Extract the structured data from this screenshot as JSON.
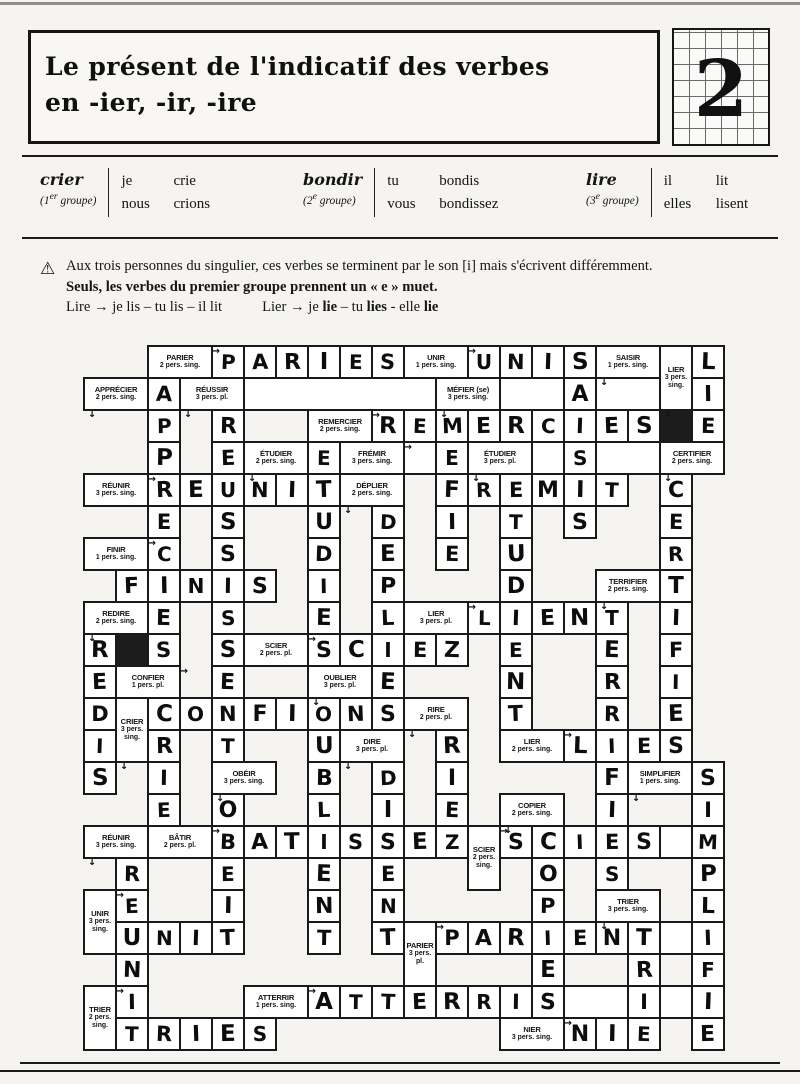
{
  "header": {
    "title_line1": "Le présent de l'indicatif des verbes",
    "title_line2": "en -ier, -ir, -ire",
    "number": "2"
  },
  "examples": [
    {
      "verb": "crier",
      "grp_open": "(1",
      "grp_sup": "er",
      "grp_close": " groupe)",
      "rows": [
        [
          "je",
          "crie"
        ],
        [
          "nous",
          "crions"
        ]
      ]
    },
    {
      "verb": "bondir",
      "grp_open": "(2",
      "grp_sup": "e",
      "grp_close": " groupe)",
      "rows": [
        [
          "tu",
          "bondis"
        ],
        [
          "vous",
          "bondissez"
        ]
      ]
    },
    {
      "verb": "lire",
      "grp_open": "(3",
      "grp_sup": "e",
      "grp_close": " groupe)",
      "rows": [
        [
          "il",
          "lit"
        ],
        [
          "elles",
          "lisent"
        ]
      ]
    }
  ],
  "note": {
    "icon": "⚠",
    "line1": "Aux trois personnes du singulier, ces verbes se terminent par le son [i] mais s'écrivent différemment.",
    "line2": "Seuls, les verbes du premier groupe prennent un « e » muet.",
    "line3_lire": "Lire → je lis – tu lis – il lit",
    "line3_lier_parts": [
      "Lier → je ",
      "lie",
      " – tu ",
      "lies",
      " - elle ",
      "lie"
    ]
  },
  "puzzle": {
    "grid": {
      "left": 84,
      "top": 346,
      "cell": 32,
      "cols": 20,
      "rows": 22
    },
    "arrow_chars": {
      "h": "→",
      "v": "↓"
    },
    "clues": [
      {
        "word": "PARIER",
        "person": "2 pers. sing.",
        "c": 2,
        "r": 0,
        "cs": 2,
        "rs": 1,
        "dir": "h"
      },
      {
        "word": "UNIR",
        "person": "1 pers. sing.",
        "c": 10,
        "r": 0,
        "cs": 2,
        "rs": 1,
        "dir": "h"
      },
      {
        "word": "SAISIR",
        "person": "1 pers. sing.",
        "c": 16,
        "r": 0,
        "cs": 2,
        "rs": 1,
        "dir": "v"
      },
      {
        "word": "LIER",
        "person": "3 pers. sing.",
        "c": 18,
        "r": 0,
        "cs": 1,
        "rs": 2,
        "dir": "v"
      },
      {
        "word": "APPRÉCIER",
        "person": "2 pers. sing.",
        "c": 0,
        "r": 1,
        "cs": 2,
        "rs": 1,
        "dir": "v"
      },
      {
        "word": "RÉUSSIR",
        "person": "3 pers. pl.",
        "c": 3,
        "r": 1,
        "cs": 2,
        "rs": 1,
        "dir": "v"
      },
      {
        "word": "MÉFIER (se)",
        "person": "3 pers. sing.",
        "c": 11,
        "r": 1,
        "cs": 2,
        "rs": 1,
        "dir": "v"
      },
      {
        "word": "REMERCIER",
        "person": "2 pers. sing.",
        "c": 7,
        "r": 2,
        "cs": 2,
        "rs": 1,
        "dir": "h"
      },
      {
        "word": "ÉTUDIER",
        "person": "2 pers. sing.",
        "c": 5,
        "r": 3,
        "cs": 2,
        "rs": 1,
        "dir": "v"
      },
      {
        "word": "FRÉMIR",
        "person": "3 pers. sing.",
        "c": 8,
        "r": 3,
        "cs": 2,
        "rs": 1,
        "dir": "h"
      },
      {
        "word": "ÉTUDIER",
        "person": "3 pers. pl.",
        "c": 12,
        "r": 3,
        "cs": 2,
        "rs": 1,
        "dir": "v"
      },
      {
        "word": "CERTIFIER",
        "person": "2 pers. sing.",
        "c": 18,
        "r": 3,
        "cs": 2,
        "rs": 1,
        "dir": "v"
      },
      {
        "word": "RÉUNIR",
        "person": "3 pers. sing.",
        "c": 0,
        "r": 4,
        "cs": 2,
        "rs": 1,
        "dir": "h"
      },
      {
        "word": "DÉPLIER",
        "person": "2 pers. sing.",
        "c": 8,
        "r": 4,
        "cs": 2,
        "rs": 1,
        "dir": "v"
      },
      {
        "word": "FINIR",
        "person": "1 pers. sing.",
        "c": 0,
        "r": 6,
        "cs": 2,
        "rs": 1,
        "dir": "h"
      },
      {
        "word": "TERRIFIER",
        "person": "2 pers. sing.",
        "c": 16,
        "r": 7,
        "cs": 2,
        "rs": 1,
        "dir": "v"
      },
      {
        "word": "REDIRE",
        "person": "2 pers. sing.",
        "c": 0,
        "r": 8,
        "cs": 2,
        "rs": 1,
        "dir": "v"
      },
      {
        "word": "LIER",
        "person": "3 pers. pl.",
        "c": 10,
        "r": 8,
        "cs": 2,
        "rs": 1,
        "dir": "h"
      },
      {
        "word": "SCIER",
        "person": "2 pers. pl.",
        "c": 5,
        "r": 9,
        "cs": 2,
        "rs": 1,
        "dir": "h"
      },
      {
        "word": "CONFIER",
        "person": "1 pers. pl.",
        "c": 1,
        "r": 10,
        "cs": 2,
        "rs": 1,
        "dir": "h"
      },
      {
        "word": "OUBLIER",
        "person": "3 pers. pl.",
        "c": 7,
        "r": 10,
        "cs": 2,
        "rs": 1,
        "dir": "v"
      },
      {
        "word": "CRIER",
        "person": "3 pers. sing.",
        "c": 1,
        "r": 11,
        "cs": 1,
        "rs": 2,
        "dir": "v"
      },
      {
        "word": "RIRE",
        "person": "2 pers. pl.",
        "c": 10,
        "r": 11,
        "cs": 2,
        "rs": 1,
        "dir": "v"
      },
      {
        "word": "DIRE",
        "person": "3 pers. pl.",
        "c": 8,
        "r": 12,
        "cs": 2,
        "rs": 1,
        "dir": "v"
      },
      {
        "word": "LIER",
        "person": "2 pers. sing.",
        "c": 13,
        "r": 12,
        "cs": 2,
        "rs": 1,
        "dir": "h"
      },
      {
        "word": "OBÉIR",
        "person": "3 pers. sing.",
        "c": 4,
        "r": 13,
        "cs": 2,
        "rs": 1,
        "dir": "v"
      },
      {
        "word": "SIMPLIFIER",
        "person": "1 pers. sing.",
        "c": 17,
        "r": 13,
        "cs": 2,
        "rs": 1,
        "dir": "v"
      },
      {
        "word": "COPIER",
        "person": "2 pers. sing.",
        "c": 13,
        "r": 14,
        "cs": 2,
        "rs": 1,
        "dir": "v"
      },
      {
        "word": "RÉUNIR",
        "person": "3 pers. sing.",
        "c": 0,
        "r": 15,
        "cs": 2,
        "rs": 1,
        "dir": "v"
      },
      {
        "word": "BÂTIR",
        "person": "2 pers. pl.",
        "c": 2,
        "r": 15,
        "cs": 2,
        "rs": 1,
        "dir": "h"
      },
      {
        "word": "SCIER",
        "person": "2 pers. sing.",
        "c": 12,
        "r": 15,
        "cs": 1,
        "rs": 2,
        "dir": "h"
      },
      {
        "word": "UNIR",
        "person": "3 pers. sing.",
        "c": 0,
        "r": 17,
        "cs": 1,
        "rs": 2,
        "dir": "h"
      },
      {
        "word": "TRIER",
        "person": "3 pers. sing.",
        "c": 16,
        "r": 17,
        "cs": 2,
        "rs": 1,
        "dir": "v"
      },
      {
        "word": "PARIER",
        "person": "3 pers. pl.",
        "c": 10,
        "r": 18,
        "cs": 1,
        "rs": 2,
        "dir": "h"
      },
      {
        "word": "ATTERRIR",
        "person": "1 pers. sing.",
        "c": 5,
        "r": 20,
        "cs": 2,
        "rs": 1,
        "dir": "h"
      },
      {
        "word": "TRIER",
        "person": "2 pers. sing.",
        "c": 0,
        "r": 20,
        "cs": 1,
        "rs": 2,
        "dir": "h"
      },
      {
        "word": "NIER",
        "person": "3 pers. sing.",
        "c": 13,
        "r": 21,
        "cs": 2,
        "rs": 1,
        "dir": "h"
      }
    ],
    "black": [
      [
        2,
        18
      ],
      [
        9,
        1
      ]
    ],
    "empty": [
      {
        "r": 1,
        "c": 5,
        "cs": 6
      },
      {
        "r": 1,
        "c": 13,
        "cs": 2
      },
      {
        "r": 1,
        "c": 16,
        "cs": 2
      },
      {
        "r": 3,
        "c": 10,
        "cs": 1
      },
      {
        "r": 3,
        "c": 14,
        "cs": 1
      },
      {
        "r": 3,
        "c": 16,
        "cs": 2
      },
      {
        "r": 15,
        "c": 18,
        "cs": 1
      },
      {
        "r": 18,
        "c": 18,
        "cs": 1
      },
      {
        "r": 20,
        "c": 15,
        "cs": 2
      },
      {
        "r": 20,
        "c": 18,
        "cs": 1
      }
    ],
    "letters": [
      [
        0,
        4,
        "P"
      ],
      [
        0,
        5,
        "A"
      ],
      [
        0,
        6,
        "R"
      ],
      [
        0,
        7,
        "I"
      ],
      [
        0,
        8,
        "E"
      ],
      [
        0,
        9,
        "S"
      ],
      [
        0,
        12,
        "U"
      ],
      [
        0,
        13,
        "N"
      ],
      [
        0,
        14,
        "I"
      ],
      [
        0,
        15,
        "S"
      ],
      [
        0,
        19,
        "L"
      ],
      [
        1,
        2,
        "A"
      ],
      [
        1,
        15,
        "A"
      ],
      [
        1,
        19,
        "I"
      ],
      [
        2,
        2,
        "P"
      ],
      [
        2,
        4,
        "R"
      ],
      [
        2,
        9,
        "R"
      ],
      [
        2,
        10,
        "E"
      ],
      [
        2,
        11,
        "M"
      ],
      [
        2,
        12,
        "E"
      ],
      [
        2,
        13,
        "R"
      ],
      [
        2,
        14,
        "C"
      ],
      [
        2,
        15,
        "I"
      ],
      [
        2,
        16,
        "E"
      ],
      [
        2,
        17,
        "S"
      ],
      [
        2,
        19,
        "E"
      ],
      [
        3,
        2,
        "P"
      ],
      [
        3,
        4,
        "E"
      ],
      [
        3,
        7,
        "E"
      ],
      [
        3,
        11,
        "E"
      ],
      [
        3,
        15,
        "S"
      ],
      [
        4,
        2,
        "R"
      ],
      [
        4,
        3,
        "E"
      ],
      [
        4,
        4,
        "U"
      ],
      [
        4,
        5,
        "N"
      ],
      [
        4,
        6,
        "I"
      ],
      [
        4,
        7,
        "T"
      ],
      [
        4,
        11,
        "F"
      ],
      [
        4,
        12,
        "R"
      ],
      [
        4,
        13,
        "E"
      ],
      [
        4,
        14,
        "M"
      ],
      [
        4,
        15,
        "I"
      ],
      [
        4,
        16,
        "T"
      ],
      [
        4,
        18,
        "C"
      ],
      [
        5,
        2,
        "E"
      ],
      [
        5,
        4,
        "S"
      ],
      [
        5,
        7,
        "U"
      ],
      [
        5,
        9,
        "D"
      ],
      [
        5,
        11,
        "I"
      ],
      [
        5,
        13,
        "T"
      ],
      [
        5,
        15,
        "S"
      ],
      [
        5,
        18,
        "E"
      ],
      [
        6,
        2,
        "C"
      ],
      [
        6,
        4,
        "S"
      ],
      [
        6,
        7,
        "D"
      ],
      [
        6,
        9,
        "E"
      ],
      [
        6,
        11,
        "E"
      ],
      [
        6,
        13,
        "U"
      ],
      [
        6,
        18,
        "R"
      ],
      [
        7,
        1,
        "F"
      ],
      [
        7,
        2,
        "I"
      ],
      [
        7,
        3,
        "N"
      ],
      [
        7,
        4,
        "I"
      ],
      [
        7,
        5,
        "S"
      ],
      [
        7,
        7,
        "I"
      ],
      [
        7,
        9,
        "P"
      ],
      [
        7,
        13,
        "D"
      ],
      [
        7,
        18,
        "T"
      ],
      [
        8,
        2,
        "E"
      ],
      [
        8,
        4,
        "S"
      ],
      [
        8,
        7,
        "E"
      ],
      [
        8,
        9,
        "L"
      ],
      [
        8,
        12,
        "L"
      ],
      [
        8,
        13,
        "I"
      ],
      [
        8,
        14,
        "E"
      ],
      [
        8,
        15,
        "N"
      ],
      [
        8,
        16,
        "T"
      ],
      [
        8,
        18,
        "I"
      ],
      [
        9,
        0,
        "R"
      ],
      [
        9,
        2,
        "S"
      ],
      [
        9,
        4,
        "S"
      ],
      [
        9,
        7,
        "S"
      ],
      [
        9,
        8,
        "C"
      ],
      [
        9,
        9,
        "I"
      ],
      [
        9,
        10,
        "E"
      ],
      [
        9,
        11,
        "Z"
      ],
      [
        9,
        13,
        "E"
      ],
      [
        9,
        16,
        "E"
      ],
      [
        9,
        18,
        "F"
      ],
      [
        10,
        0,
        "E"
      ],
      [
        10,
        4,
        "E"
      ],
      [
        10,
        9,
        "E"
      ],
      [
        10,
        13,
        "N"
      ],
      [
        10,
        16,
        "R"
      ],
      [
        10,
        18,
        "I"
      ],
      [
        11,
        0,
        "D"
      ],
      [
        11,
        2,
        "C"
      ],
      [
        11,
        3,
        "O"
      ],
      [
        11,
        4,
        "N"
      ],
      [
        11,
        5,
        "F"
      ],
      [
        11,
        6,
        "I"
      ],
      [
        11,
        7,
        "O"
      ],
      [
        11,
        8,
        "N"
      ],
      [
        11,
        9,
        "S"
      ],
      [
        11,
        13,
        "T"
      ],
      [
        11,
        16,
        "R"
      ],
      [
        11,
        18,
        "E"
      ],
      [
        12,
        0,
        "I"
      ],
      [
        12,
        2,
        "R"
      ],
      [
        12,
        4,
        "T"
      ],
      [
        12,
        7,
        "U"
      ],
      [
        12,
        11,
        "R"
      ],
      [
        12,
        15,
        "L"
      ],
      [
        12,
        16,
        "I"
      ],
      [
        12,
        17,
        "E"
      ],
      [
        12,
        18,
        "S"
      ],
      [
        13,
        0,
        "S"
      ],
      [
        13,
        2,
        "I"
      ],
      [
        13,
        7,
        "B"
      ],
      [
        13,
        9,
        "D"
      ],
      [
        13,
        11,
        "I"
      ],
      [
        13,
        16,
        "F"
      ],
      [
        13,
        19,
        "S"
      ],
      [
        14,
        2,
        "E"
      ],
      [
        14,
        4,
        "O"
      ],
      [
        14,
        7,
        "L"
      ],
      [
        14,
        9,
        "I"
      ],
      [
        14,
        11,
        "E"
      ],
      [
        14,
        16,
        "I"
      ],
      [
        14,
        19,
        "I"
      ],
      [
        15,
        4,
        "B"
      ],
      [
        15,
        5,
        "A"
      ],
      [
        15,
        6,
        "T"
      ],
      [
        15,
        7,
        "I"
      ],
      [
        15,
        8,
        "S"
      ],
      [
        15,
        9,
        "S"
      ],
      [
        15,
        10,
        "E"
      ],
      [
        15,
        11,
        "Z"
      ],
      [
        15,
        13,
        "S"
      ],
      [
        15,
        14,
        "C"
      ],
      [
        15,
        15,
        "I"
      ],
      [
        15,
        16,
        "E"
      ],
      [
        15,
        17,
        "S"
      ],
      [
        15,
        19,
        "M"
      ],
      [
        16,
        1,
        "R"
      ],
      [
        16,
        4,
        "E"
      ],
      [
        16,
        7,
        "E"
      ],
      [
        16,
        9,
        "E"
      ],
      [
        16,
        14,
        "O"
      ],
      [
        16,
        16,
        "S"
      ],
      [
        16,
        19,
        "P"
      ],
      [
        17,
        1,
        "E"
      ],
      [
        17,
        4,
        "I"
      ],
      [
        17,
        7,
        "N"
      ],
      [
        17,
        9,
        "N"
      ],
      [
        17,
        14,
        "P"
      ],
      [
        17,
        19,
        "L"
      ],
      [
        18,
        1,
        "U"
      ],
      [
        18,
        2,
        "N"
      ],
      [
        18,
        3,
        "I"
      ],
      [
        18,
        4,
        "T"
      ],
      [
        18,
        7,
        "T"
      ],
      [
        18,
        9,
        "T"
      ],
      [
        18,
        11,
        "P"
      ],
      [
        18,
        12,
        "A"
      ],
      [
        18,
        13,
        "R"
      ],
      [
        18,
        14,
        "I"
      ],
      [
        18,
        15,
        "E"
      ],
      [
        18,
        16,
        "N"
      ],
      [
        18,
        17,
        "T"
      ],
      [
        18,
        19,
        "I"
      ],
      [
        19,
        1,
        "N"
      ],
      [
        19,
        14,
        "E"
      ],
      [
        19,
        17,
        "R"
      ],
      [
        19,
        19,
        "F"
      ],
      [
        20,
        1,
        "I"
      ],
      [
        20,
        7,
        "A"
      ],
      [
        20,
        8,
        "T"
      ],
      [
        20,
        9,
        "T"
      ],
      [
        20,
        10,
        "E"
      ],
      [
        20,
        11,
        "R"
      ],
      [
        20,
        12,
        "R"
      ],
      [
        20,
        13,
        "I"
      ],
      [
        20,
        14,
        "S"
      ],
      [
        20,
        17,
        "I"
      ],
      [
        20,
        19,
        "I"
      ],
      [
        21,
        1,
        "T"
      ],
      [
        21,
        2,
        "R"
      ],
      [
        21,
        3,
        "I"
      ],
      [
        21,
        4,
        "E"
      ],
      [
        21,
        5,
        "S"
      ],
      [
        21,
        15,
        "N"
      ],
      [
        21,
        16,
        "I"
      ],
      [
        21,
        17,
        "E"
      ],
      [
        21,
        19,
        "E"
      ]
    ]
  }
}
